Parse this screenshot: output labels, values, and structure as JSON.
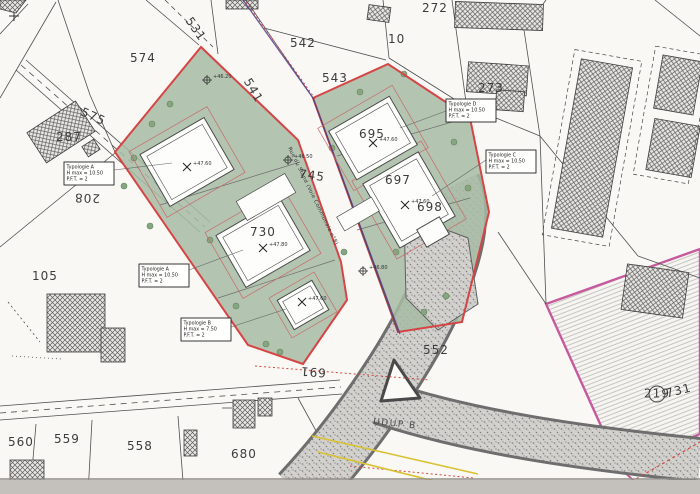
{
  "title": "Plan de masse cadastral",
  "colors": {
    "site_outline": "#d64545",
    "green_fill": "#a7bba3",
    "pink_outline": "#c75a9e",
    "purple_line": "#544088",
    "yellow_line": "#d9c232",
    "gravel": "#c9c8c4"
  },
  "parcels": {
    "p574": "574",
    "p542": "542",
    "p543": "543",
    "p10": "10",
    "p272": "272",
    "p273": "273",
    "p575": "575",
    "p287": "287",
    "p208": "208",
    "p105": "105",
    "p531": "531",
    "p541": "541",
    "p745": "745",
    "p730": "730",
    "p695": "695",
    "p697": "697",
    "p698": "698",
    "p691": "691",
    "p552": "552",
    "p560": "560",
    "p559": "559",
    "p558": "558",
    "p680": "680",
    "p219": "219",
    "p731": "731"
  },
  "streets": {
    "main_road": "Rue du Stand (Voie Communale n°8)",
    "zone_label": "UDUP B"
  },
  "typology": {
    "a1": {
      "title": "Typologie A",
      "hmax": "H max = 10.50",
      "pft": "P.F.T. = 2"
    },
    "a2": {
      "title": "Typologie A",
      "hmax": "H max = 10.50",
      "pft": "P.F.T. = 2"
    },
    "b": {
      "title": "Typologie B",
      "hmax": "H max = 7.50",
      "pft": "P.F.T. = 2"
    },
    "c": {
      "title": "Typologie C",
      "hmax": "H max = 10.50",
      "pft": "P.F.T. = 2"
    },
    "d": {
      "title": "Typologie D",
      "hmax": "H max = 10.50",
      "pft": "P.F.T. = 2"
    }
  },
  "elev": {
    "r1": "+46.20",
    "r2": "+46.50",
    "r3": "+46.80",
    "a1": "+47.60",
    "b730": "+47.80",
    "bb": "+47.60",
    "b695": "+47.60",
    "b697": "+47.60"
  }
}
